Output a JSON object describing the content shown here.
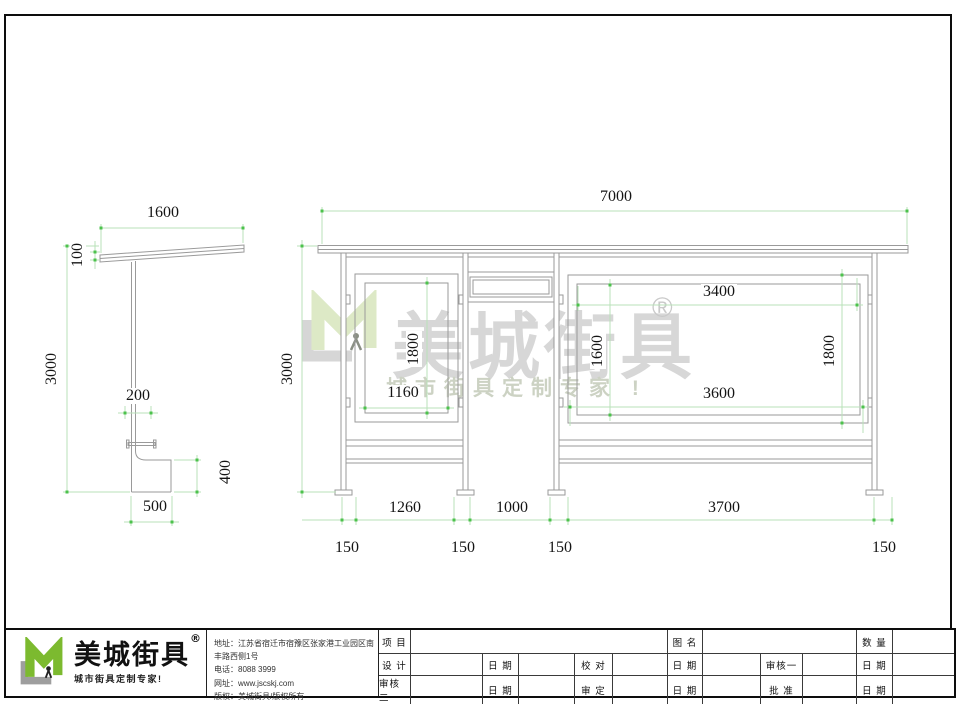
{
  "colors": {
    "dim_line": "#b9e2b9",
    "dim_tick": "#4cc24c",
    "structure_gray": "#9a9a9a",
    "logo_green": "#7cba2f",
    "watermark_green": "#dde9c6",
    "watermark_gray": "#d7d7d7"
  },
  "dims": {
    "side": {
      "roof_width": "1600",
      "roof_thickness": "100",
      "height": "3000",
      "post_offset": "200",
      "bench_height": "400",
      "bench_width": "500"
    },
    "front": {
      "total_width": "7000",
      "height": "3000",
      "left_panel_height": "1800",
      "left_panel_width": "1160",
      "board_inner_width": "3400",
      "board_inner_height": "1600",
      "board_outer_height": "1800",
      "board_outer_width": "3600",
      "bay_left": "1260",
      "bay_middle": "1000",
      "bay_right": "3700",
      "base_1": "150",
      "base_2": "150",
      "base_3": "150",
      "base_4": "150"
    }
  },
  "watermark": {
    "brand": "美城街具",
    "registered": "®",
    "tagline": "城市街具定制专家 !"
  },
  "title_block": {
    "logo": {
      "brand": "美城街具",
      "registered": "®",
      "tagline": "城市街具定制专家!"
    },
    "company": {
      "address": "地址：江苏省宿迁市宿豫区张家港工业园区南丰路西侧1号",
      "phone": "电话：8088 3999",
      "website": "网址：www.jscskj.com",
      "copyright": "版权：美城街具/版权所有"
    },
    "table": {
      "project": "项 目",
      "drawing_name": "图 名",
      "quantity": "数 量",
      "design": "设 计",
      "date": "日 期",
      "proofread": "校 对",
      "reviewer1": "审核一",
      "reviewer2": "审核二",
      "verify": "审 定",
      "approve": "批 准"
    }
  }
}
